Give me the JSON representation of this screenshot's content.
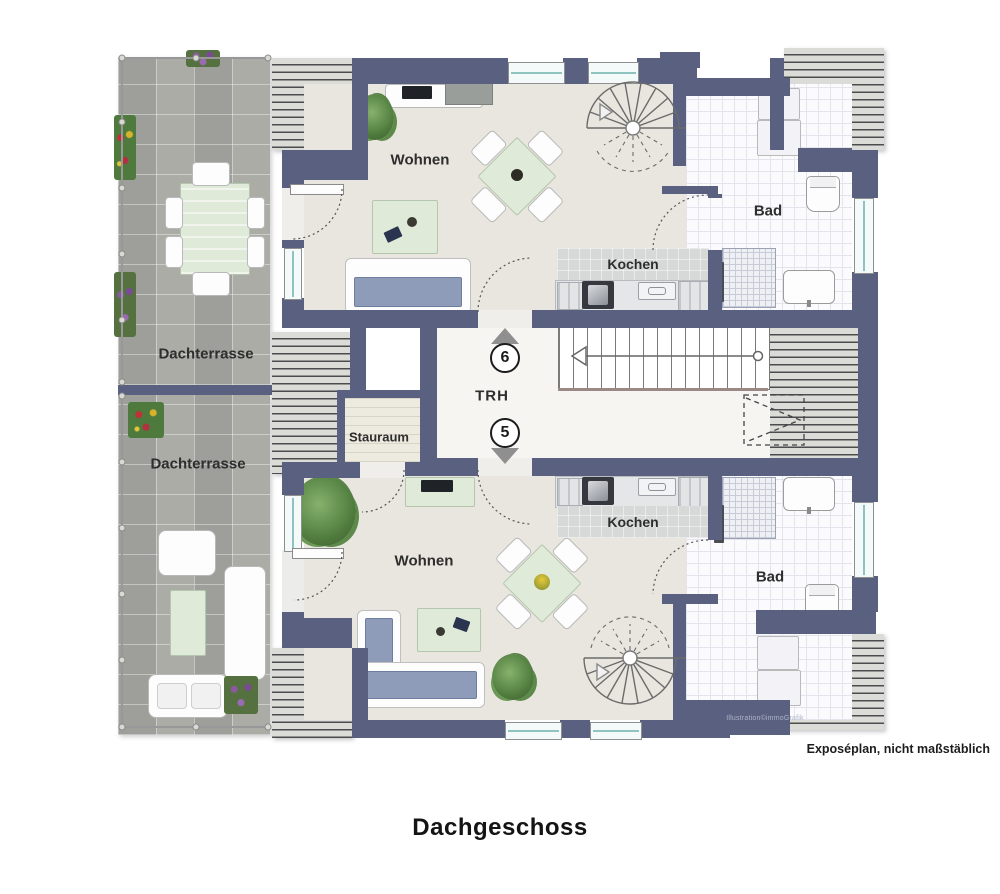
{
  "title": "Dachgeschoss",
  "credit": "Illustration©immoGrafik",
  "disclaimer": "Exposéplan, nicht maßstäblich",
  "stairwell": {
    "label": "TRH",
    "upper_unit_number": "6",
    "lower_unit_number": "5"
  },
  "rooms": {
    "upper_living": "Wohnen",
    "upper_kitchen": "Kochen",
    "upper_bath": "Bad",
    "lower_living": "Wohnen",
    "lower_kitchen": "Kochen",
    "lower_bath": "Bad",
    "storage": "Stauraum",
    "terrace_top": "Dachterrasse",
    "terrace_bottom": "Dachterrasse"
  },
  "colors": {
    "wall": "#5a6080",
    "floor": "#e9e6df",
    "terrace_tile": "#a7a7a2",
    "bath_tile": "#fbfbfd",
    "furniture_green": "#e0ead9",
    "sofa_blue": "#8e9cba",
    "window_glass": "#8fc3c0"
  }
}
